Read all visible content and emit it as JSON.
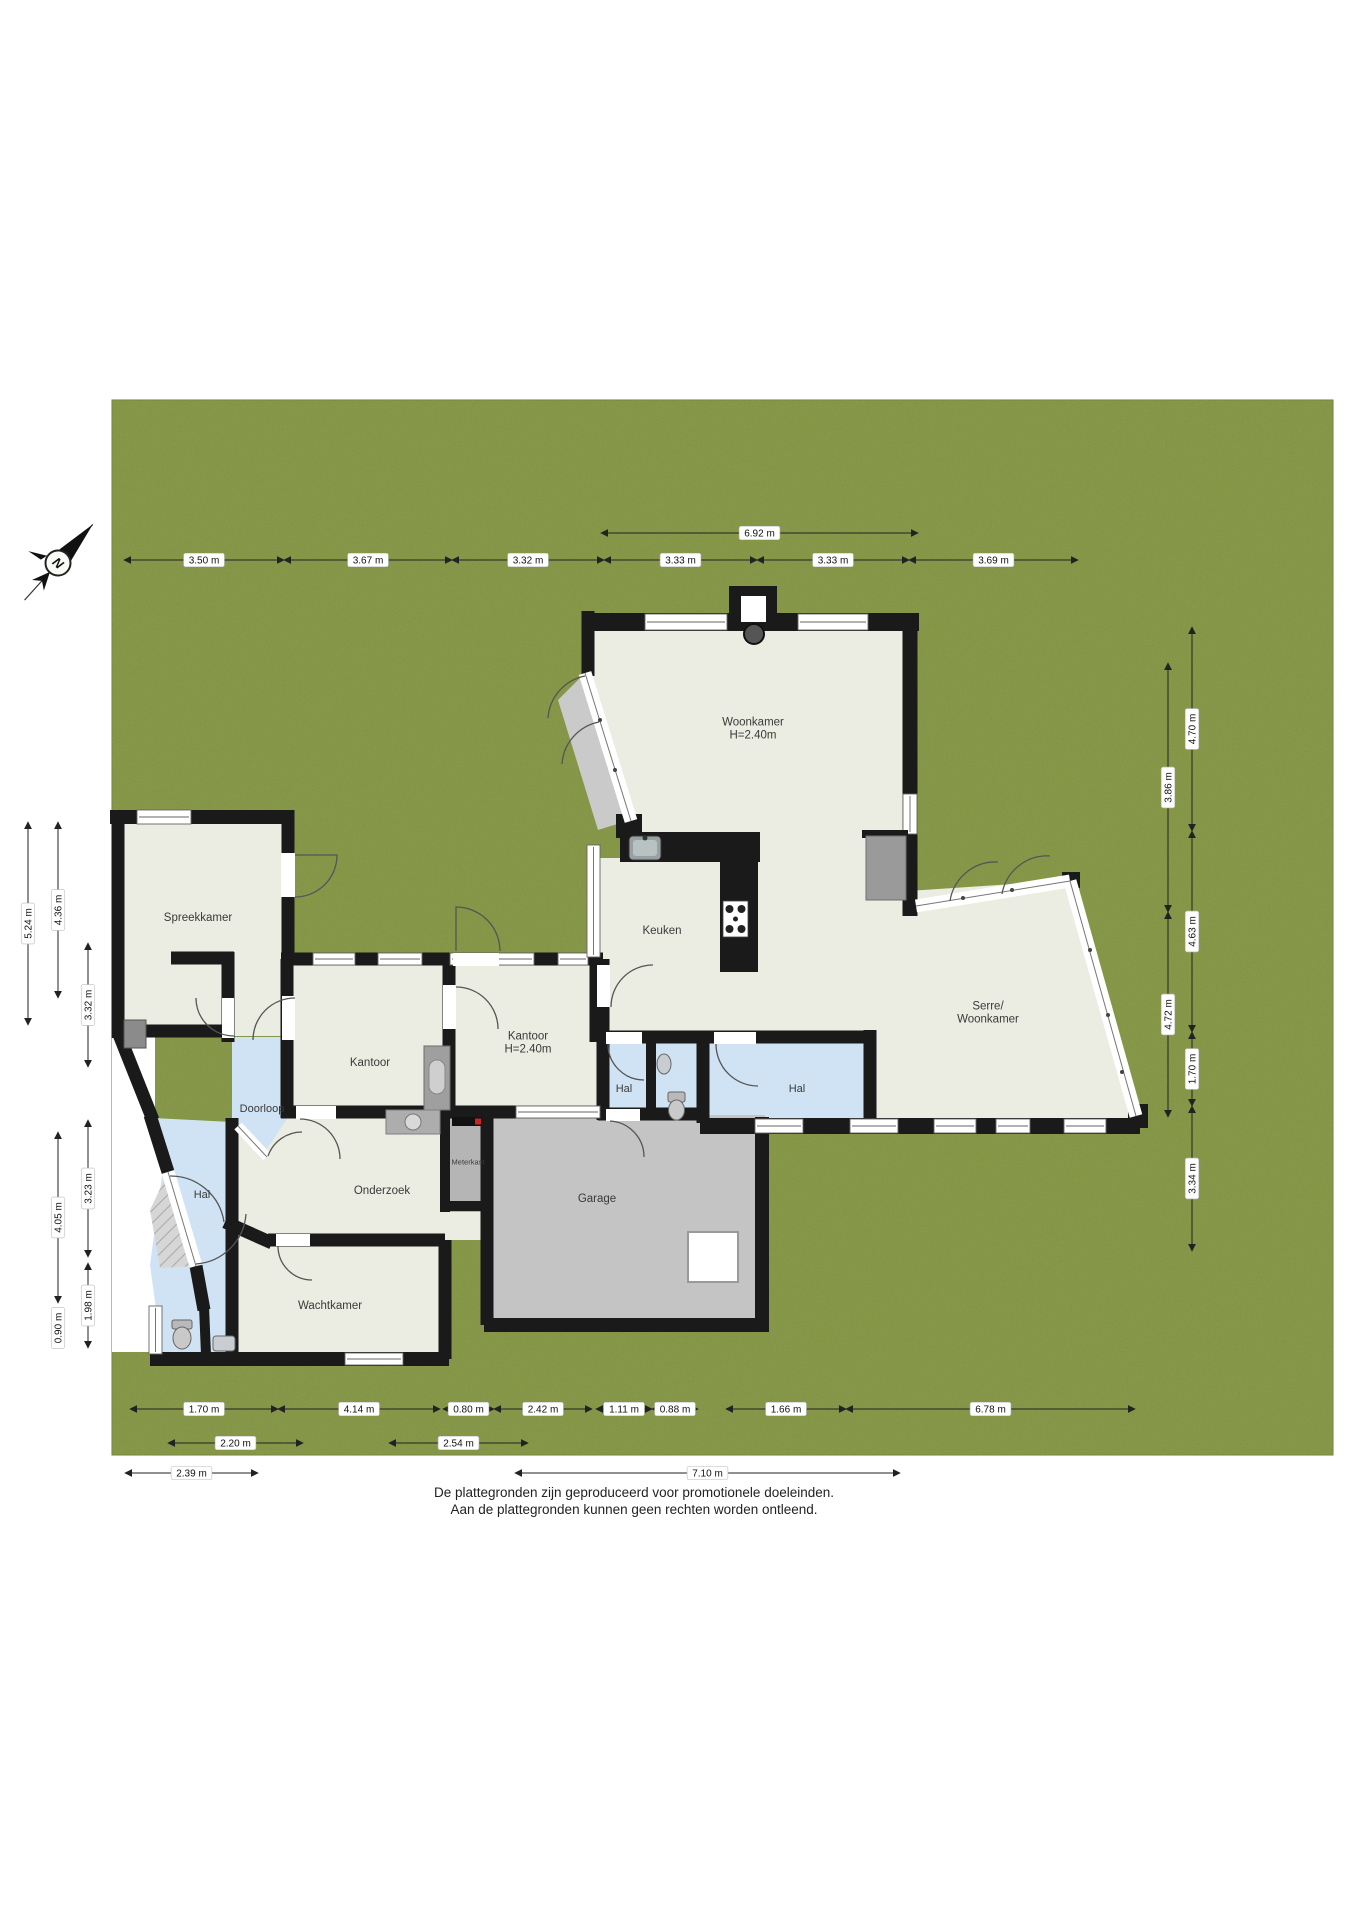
{
  "compass": {
    "label": "N"
  },
  "footer": {
    "line1": "De plattegronden zijn geproduceerd voor promotionele doeleinden.",
    "line2": "Aan de plattegronden kunnen geen rechten worden ontleend."
  },
  "colors": {
    "grass": "#7E9140",
    "wall": "#1A1A1A",
    "floor_cream": "#EBECE2",
    "floor_wet_blue": "#CFE3F4",
    "floor_garage_gray": "#C4C4C4",
    "dimension_text": "#111111"
  },
  "rooms": [
    {
      "lines": [
        "Woonkamer",
        "H=2.40m"
      ],
      "x": 753,
      "y": 728,
      "size": 11.5
    },
    {
      "lines": [
        "Keuken"
      ],
      "x": 662,
      "y": 930,
      "size": 11.5
    },
    {
      "lines": [
        "Serre/",
        "Woonkamer"
      ],
      "x": 988,
      "y": 1012,
      "size": 11.5
    },
    {
      "lines": [
        "Spreekkamer"
      ],
      "x": 198,
      "y": 917,
      "size": 11.5
    },
    {
      "lines": [
        "Kantoor"
      ],
      "x": 370,
      "y": 1062,
      "size": 11.5
    },
    {
      "lines": [
        "Kantoor",
        "H=2.40m"
      ],
      "x": 528,
      "y": 1042,
      "size": 11.5
    },
    {
      "lines": [
        "Hal"
      ],
      "x": 624,
      "y": 1088,
      "size": 11
    },
    {
      "lines": [
        "Hal"
      ],
      "x": 797,
      "y": 1088,
      "size": 11
    },
    {
      "lines": [
        "Doorloop"
      ],
      "x": 262,
      "y": 1108,
      "size": 11
    },
    {
      "lines": [
        "Hal"
      ],
      "x": 202,
      "y": 1194,
      "size": 11
    },
    {
      "lines": [
        "Onderzoek"
      ],
      "x": 382,
      "y": 1190,
      "size": 11.5
    },
    {
      "lines": [
        "Meterkast"
      ],
      "x": 468,
      "y": 1162,
      "size": 7.5
    },
    {
      "lines": [
        "Garage"
      ],
      "x": 597,
      "y": 1198,
      "size": 11.5
    },
    {
      "lines": [
        "Wachtkamer"
      ],
      "x": 330,
      "y": 1305,
      "size": 11.5
    }
  ],
  "dimensions": [
    {
      "o": "h",
      "x1": 601,
      "x2": 918,
      "y": 533,
      "t": "6.92 m"
    },
    {
      "o": "h",
      "x1": 124,
      "x2": 284,
      "y": 560,
      "t": "3.50 m"
    },
    {
      "o": "h",
      "x1": 284,
      "x2": 452,
      "y": 560,
      "t": "3.67 m"
    },
    {
      "o": "h",
      "x1": 452,
      "x2": 604,
      "y": 560,
      "t": "3.32 m"
    },
    {
      "o": "h",
      "x1": 604,
      "x2": 757,
      "y": 560,
      "t": "3.33 m"
    },
    {
      "o": "h",
      "x1": 757,
      "x2": 909,
      "y": 560,
      "t": "3.33 m"
    },
    {
      "o": "h",
      "x1": 909,
      "x2": 1078,
      "y": 560,
      "t": "3.69 m"
    },
    {
      "o": "v",
      "x": 28,
      "y1": 822,
      "y2": 1025,
      "t": "5.24 m"
    },
    {
      "o": "v",
      "x": 58,
      "y1": 822,
      "y2": 998,
      "t": "4.36 m"
    },
    {
      "o": "v",
      "x": 88,
      "y1": 943,
      "y2": 1067,
      "t": "3.32 m"
    },
    {
      "o": "v",
      "x": 58,
      "y1": 1132,
      "y2": 1303,
      "t": "4.05 m"
    },
    {
      "o": "v",
      "x": 58,
      "y1": 1308,
      "y2": 1348,
      "t": "0.90 m"
    },
    {
      "o": "v",
      "x": 88,
      "y1": 1120,
      "y2": 1257,
      "t": "3.23 m"
    },
    {
      "o": "v",
      "x": 88,
      "y1": 1263,
      "y2": 1348,
      "t": "1.98 m"
    },
    {
      "o": "v",
      "x": 1168,
      "y1": 663,
      "y2": 912,
      "t": "3.86 m"
    },
    {
      "o": "v",
      "x": 1168,
      "y1": 912,
      "y2": 1117,
      "t": "4.72 m"
    },
    {
      "o": "v",
      "x": 1192,
      "y1": 627,
      "y2": 831,
      "t": "4.70 m"
    },
    {
      "o": "v",
      "x": 1192,
      "y1": 831,
      "y2": 1032,
      "t": "4.63 m"
    },
    {
      "o": "v",
      "x": 1192,
      "y1": 1032,
      "y2": 1106,
      "t": "1.70 m"
    },
    {
      "o": "v",
      "x": 1192,
      "y1": 1106,
      "y2": 1251,
      "t": "3.34 m"
    },
    {
      "o": "h",
      "x1": 130,
      "x2": 278,
      "y": 1409,
      "t": "1.70 m"
    },
    {
      "o": "h",
      "x1": 278,
      "x2": 440,
      "y": 1409,
      "t": "4.14 m"
    },
    {
      "o": "h",
      "x1": 443,
      "x2": 494,
      "y": 1409,
      "t": "0.80 m"
    },
    {
      "o": "h",
      "x1": 494,
      "x2": 592,
      "y": 1409,
      "t": "2.42 m"
    },
    {
      "o": "h",
      "x1": 596,
      "x2": 652,
      "y": 1409,
      "t": "1.11 m"
    },
    {
      "o": "h",
      "x1": 652,
      "x2": 698,
      "y": 1409,
      "t": "0.88 m"
    },
    {
      "o": "h",
      "x1": 726,
      "x2": 846,
      "y": 1409,
      "t": "1.66 m"
    },
    {
      "o": "h",
      "x1": 846,
      "x2": 1135,
      "y": 1409,
      "t": "6.78 m"
    },
    {
      "o": "h",
      "x1": 168,
      "x2": 303,
      "y": 1443,
      "t": "2.20 m"
    },
    {
      "o": "h",
      "x1": 389,
      "x2": 528,
      "y": 1443,
      "t": "2.54 m"
    },
    {
      "o": "h",
      "x1": 125,
      "x2": 258,
      "y": 1473,
      "t": "2.39 m"
    },
    {
      "o": "h",
      "x1": 515,
      "x2": 900,
      "y": 1473,
      "t": "7.10 m"
    }
  ]
}
